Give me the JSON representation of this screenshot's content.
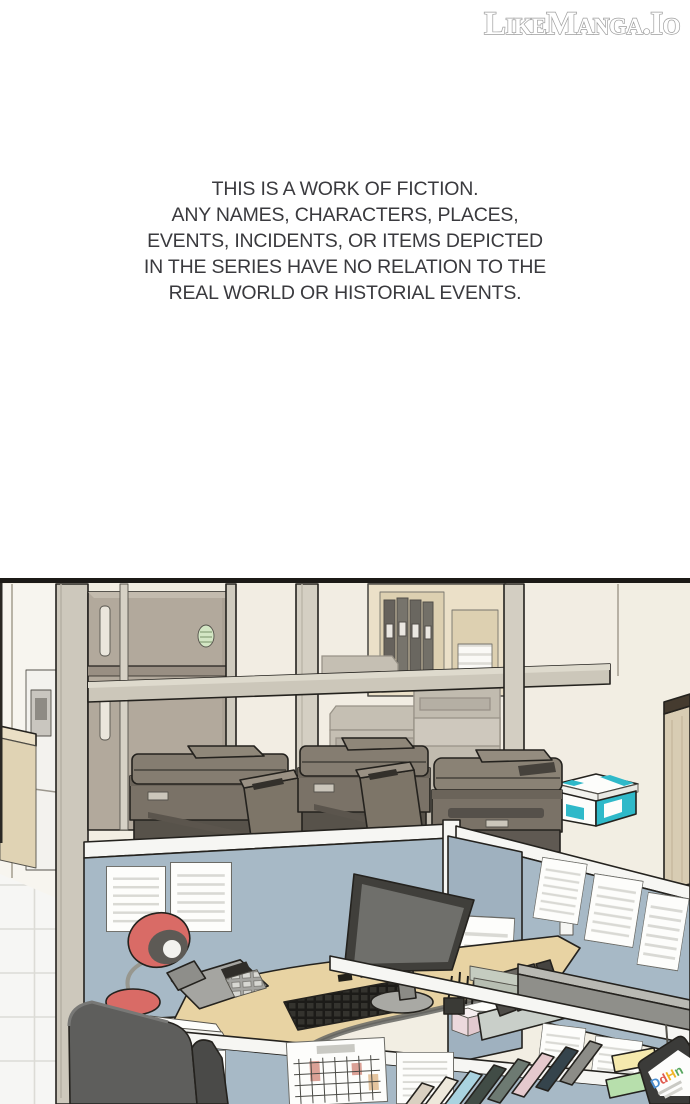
{
  "header": {
    "logo_text": "LikeManga.Io"
  },
  "disclaimer": {
    "text": "THIS IS A WORK OF FICTION.\nANY NAMES, CHARACTERS, PLACES,\nEVENTS, INCIDENTS, OR ITEMS DEPICTED\nIN THE SERIES HAVE NO RELATION TO THE\nREAL WORLD OR HISTORIAL EVENTS."
  },
  "panel": {
    "alt": "Webtoon panel: office interior with a break-room refrigerator, glass wall, shelf with binders, three multifunction printers on a counter, a teal paper box, and blue-gray cubicles with desk, monitor, phone, red lamp, calendar, sticky notes, books and an office chair",
    "palette": {
      "wall_cream": "#f2eee3",
      "partition_blue": "#a7b9c6",
      "rail_white": "#f6f6f3",
      "desk_wood": "#e8d3a3",
      "printer_gray": "#7a7267",
      "fridge_taupe": "#b2a99c",
      "shelf_beige": "#e9ddc1",
      "lamp_red": "#d96b66",
      "box_teal": "#2fb9c9",
      "chair_gray": "#5e5e5c",
      "outline": "#24221e"
    },
    "monitor_logo": {
      "letters": [
        {
          "ch": "D",
          "color": "#4a8fd3"
        },
        {
          "ch": "d",
          "color": "#e05a4e"
        },
        {
          "ch": "H",
          "color": "#f0b428"
        },
        {
          "ch": "n",
          "color": "#57a75f"
        }
      ]
    }
  }
}
